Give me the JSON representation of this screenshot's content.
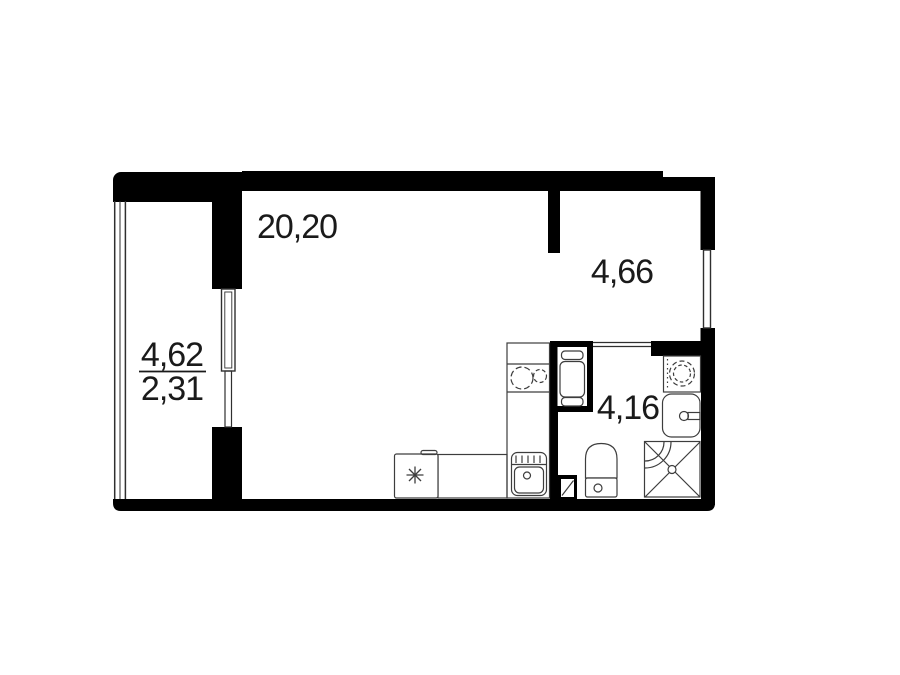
{
  "plan": {
    "title": "studio-apartment-floor-plan",
    "rooms": [
      {
        "id": "living-kitchen",
        "area_label": "20,20"
      },
      {
        "id": "hallway",
        "area_label": "4,66"
      },
      {
        "id": "bathroom",
        "area_label": "4,16"
      },
      {
        "id": "balcony",
        "area_label": "4,62",
        "reduced_area_label": "2,31"
      }
    ],
    "colors": {
      "wall": "#000000",
      "line": "#2f2f2f",
      "fixture_line": "#3d3d3d",
      "text": "#1a1a1a",
      "background": "#ffffff"
    },
    "fixtures": [
      "fridge",
      "kitchen-counter",
      "stove",
      "kitchen-sink",
      "water-heater-niche",
      "washing-machine",
      "bathroom-sink",
      "shower",
      "toilet",
      "vent-shaft",
      "balcony-glazing",
      "balcony-door-window",
      "hallway-window",
      "bathroom-door-opening"
    ]
  }
}
